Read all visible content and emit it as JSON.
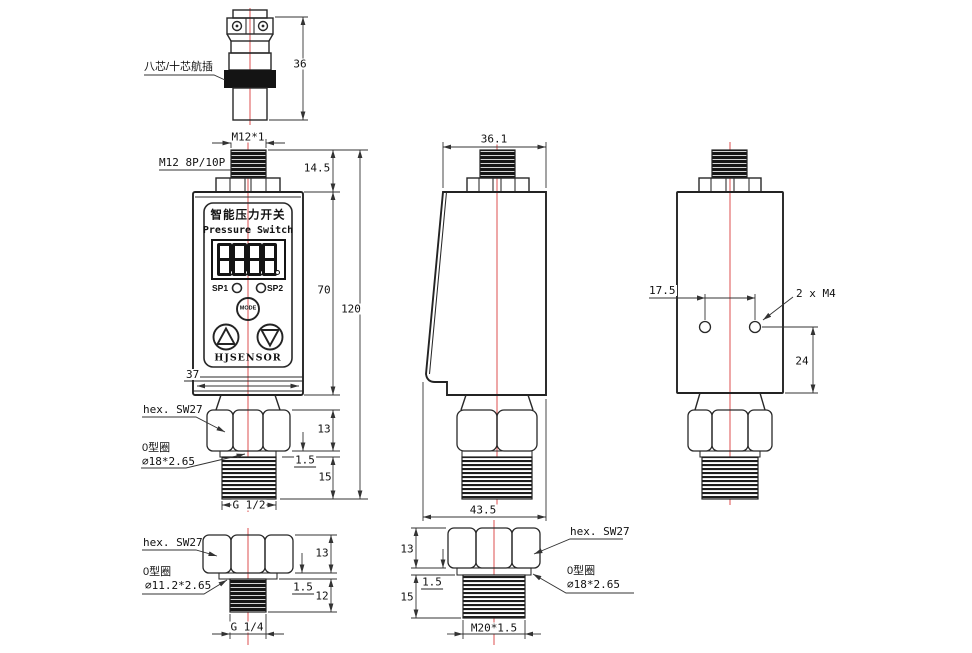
{
  "connector": {
    "label": "八芯/十芯航插",
    "dim_height": "36"
  },
  "front": {
    "dim_thread": "M12*1",
    "label_plug": "M12 8P/10P",
    "dim_top": "14.5",
    "dim_body": "70",
    "dim_total": "120",
    "dim_width": "37",
    "dim_hex": "13",
    "dim_oring": "1.5",
    "dim_thread_len": "15",
    "label_hex": "hex. SW27",
    "label_oring": "0型圈",
    "label_oring_spec": "∅18*2.65",
    "dim_port": "G 1/2",
    "panel": {
      "title_cn": "智能压力开关",
      "title_en": "Pressure Switch",
      "display": "8888",
      "sp1": "SP1",
      "sp2": "SP2",
      "mode": "MODE",
      "brand": "HJSENSOR"
    }
  },
  "side": {
    "dim_top_width": "36.1",
    "dim_bottom_width": "43.5"
  },
  "rear": {
    "dim_hole_spacing": "17.5",
    "label_holes": "2 x M4",
    "dim_hole_offset": "24"
  },
  "fitting_g14": {
    "label_hex": "hex. SW27",
    "label_oring": "0型圈",
    "label_oring_spec": "∅11.2*2.65",
    "dim_hex": "13",
    "dim_oring": "1.5",
    "dim_thread_len": "12",
    "dim_port": "G 1/4"
  },
  "fitting_m20": {
    "dim_hex": "13",
    "dim_oring": "1.5",
    "dim_thread_len": "15",
    "label_hex": "hex. SW27",
    "label_oring": "0型圈",
    "label_oring_spec": "∅18*2.65",
    "dim_port": "M20*1.5"
  },
  "colors": {
    "centerline": "#e05f5f",
    "line": "#282828"
  }
}
